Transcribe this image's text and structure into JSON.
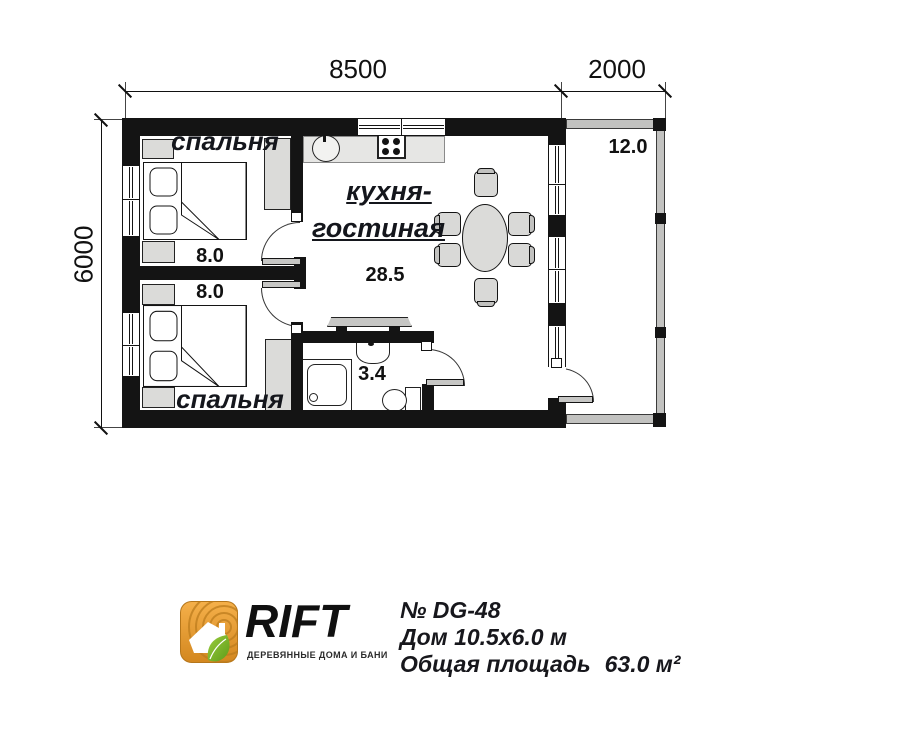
{
  "plan": {
    "dimensions": {
      "top_main": "8500",
      "top_terrace": "2000",
      "left": "6000"
    },
    "rooms": {
      "bedroom1": {
        "label": "спальня",
        "area": "8.0"
      },
      "bedroom2": {
        "label": "спальня",
        "area": "8.0"
      },
      "kitchen_living": {
        "label_line1": "кухня-",
        "label_line2": "гостиная",
        "area": "28.5"
      },
      "bathroom": {
        "area": "3.4"
      },
      "terrace": {
        "area": "12.0"
      }
    }
  },
  "footer": {
    "logo": {
      "name": "RIFT",
      "tagline": "ДЕРЕВЯННЫЕ ДОМА И БАНИ"
    },
    "info": {
      "number": "№ DG-48",
      "size": "Дом 10.5x6.0 м",
      "total_area_label": "Общая площадь",
      "total_area_value": "63.0 м²"
    }
  },
  "colors": {
    "wall": "#141414",
    "furniture": "#dbdbd9",
    "terrace_wall": "#c2c2c0",
    "logo_orange": "#E8A33D",
    "logo_green": "#76B82A"
  }
}
